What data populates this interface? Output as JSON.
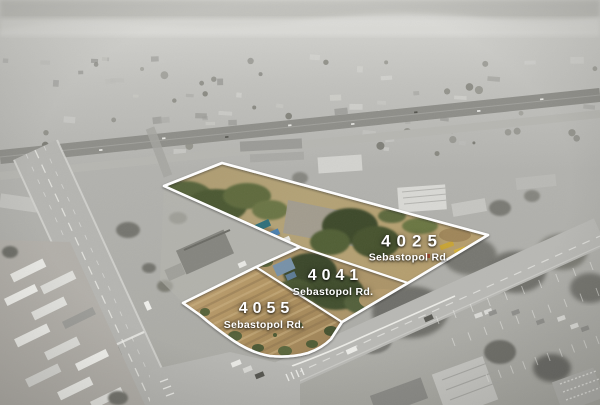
{
  "parcels": [
    {
      "number": "4025",
      "street": "Sebastopol Rd."
    },
    {
      "number": "4041",
      "street": "Sebastopol Rd."
    },
    {
      "number": "4055",
      "street": "Sebastopol Rd."
    }
  ],
  "colors": {
    "boundary_line": "#ffffff",
    "label_text": "#ffffff"
  }
}
